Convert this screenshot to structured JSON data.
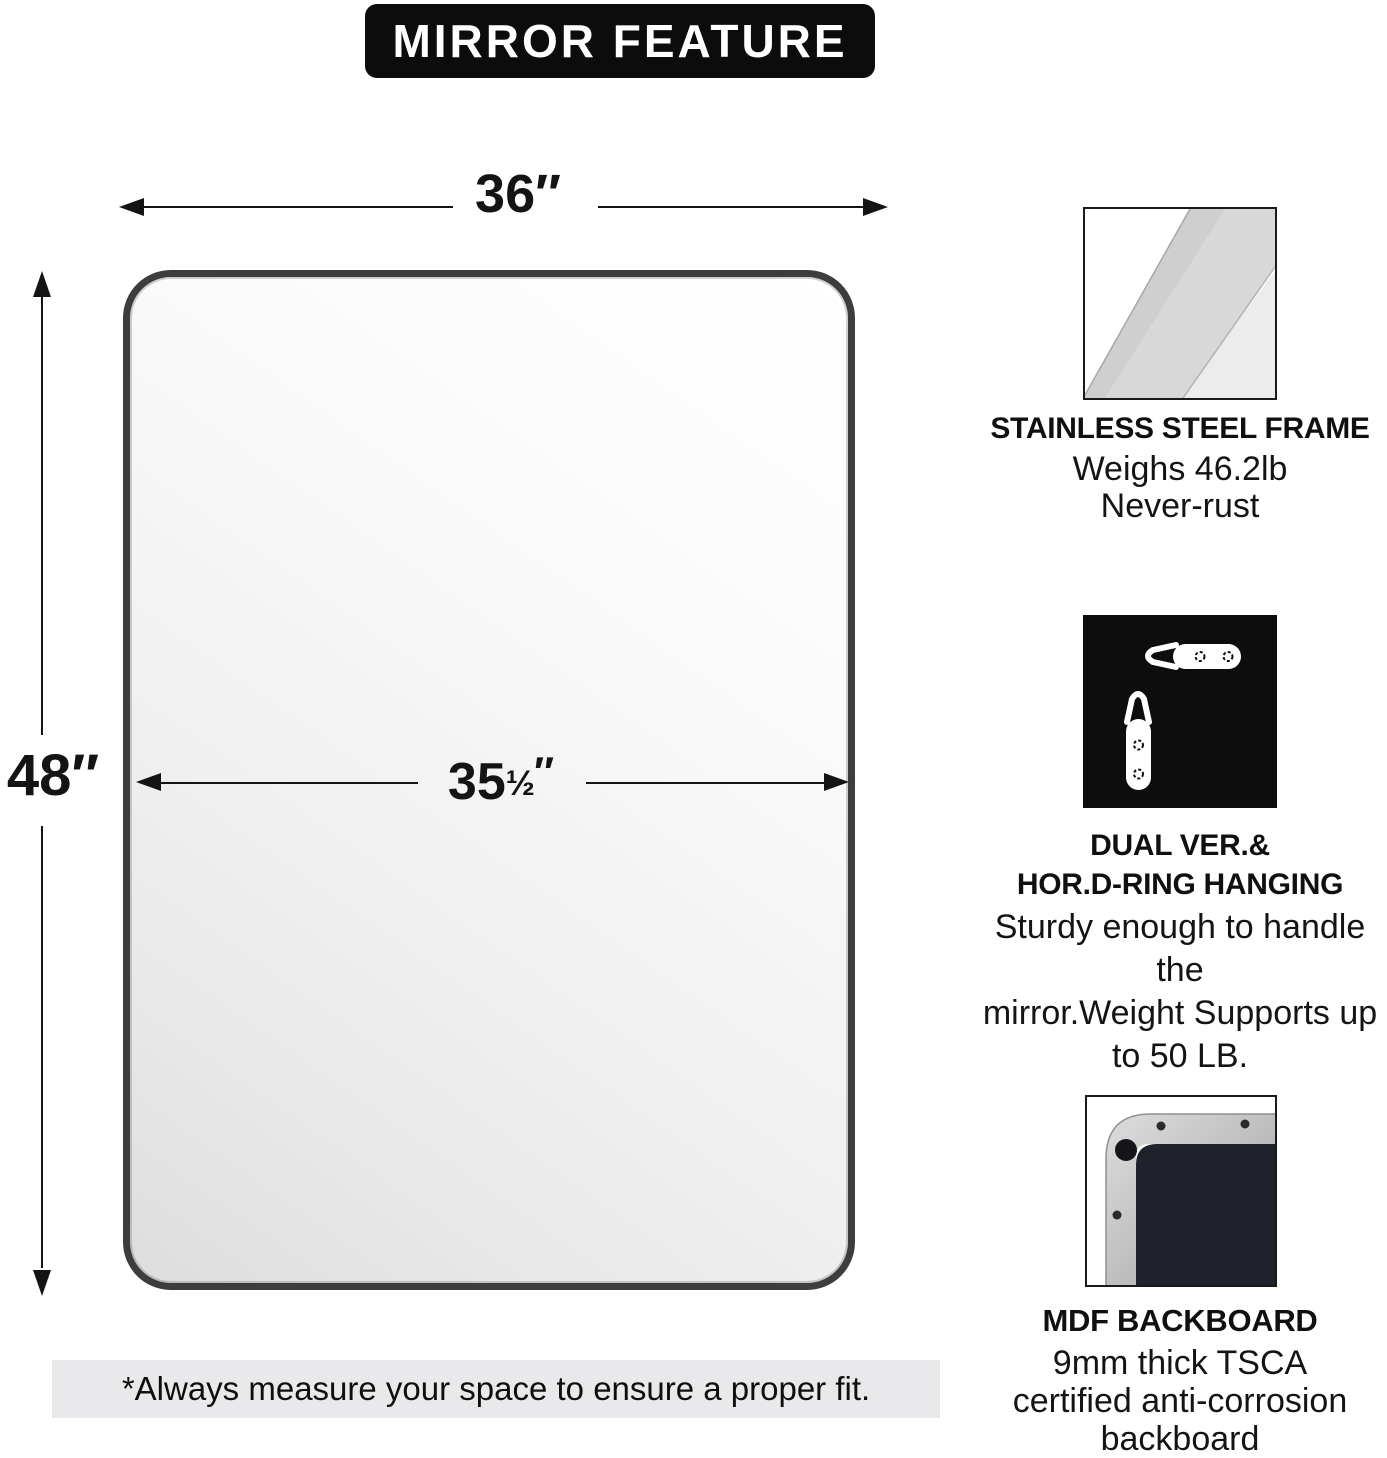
{
  "banner": {
    "title": "MIRROR FEATURE"
  },
  "dimensions": {
    "outer_width": "36″",
    "outer_height": "48″",
    "inner_width_number": "35",
    "inner_width_fraction": "½",
    "inner_width_prime": "″"
  },
  "note": "*Always measure your space to ensure a proper fit.",
  "features": [
    {
      "icon": "steel-frame-swatch",
      "title_lines": [
        "STAINLESS STEEL FRAME"
      ],
      "body_lines": [
        "Weighs 46.2lb",
        "Never-rust"
      ]
    },
    {
      "icon": "d-ring-hangers",
      "title_lines": [
        "DUAL VER.&",
        "HOR.D-RING HANGING"
      ],
      "body_lines": [
        "Sturdy enough to handle the",
        "mirror.Weight Supports up",
        "to 50 LB."
      ]
    },
    {
      "icon": "backboard-corner",
      "title_lines": [
        "MDF BACKBOARD"
      ],
      "body_lines": [
        "9mm thick TSCA",
        "certified anti-corrosion",
        "backboard"
      ]
    }
  ],
  "colors": {
    "banner_bg": "#0c0c0c",
    "text": "#111111",
    "mirror_frame": "#3d3d3d",
    "note_bg": "#e9e9eb",
    "dark_icon_bg": "#0d0d0d",
    "backboard": "#20222b"
  }
}
